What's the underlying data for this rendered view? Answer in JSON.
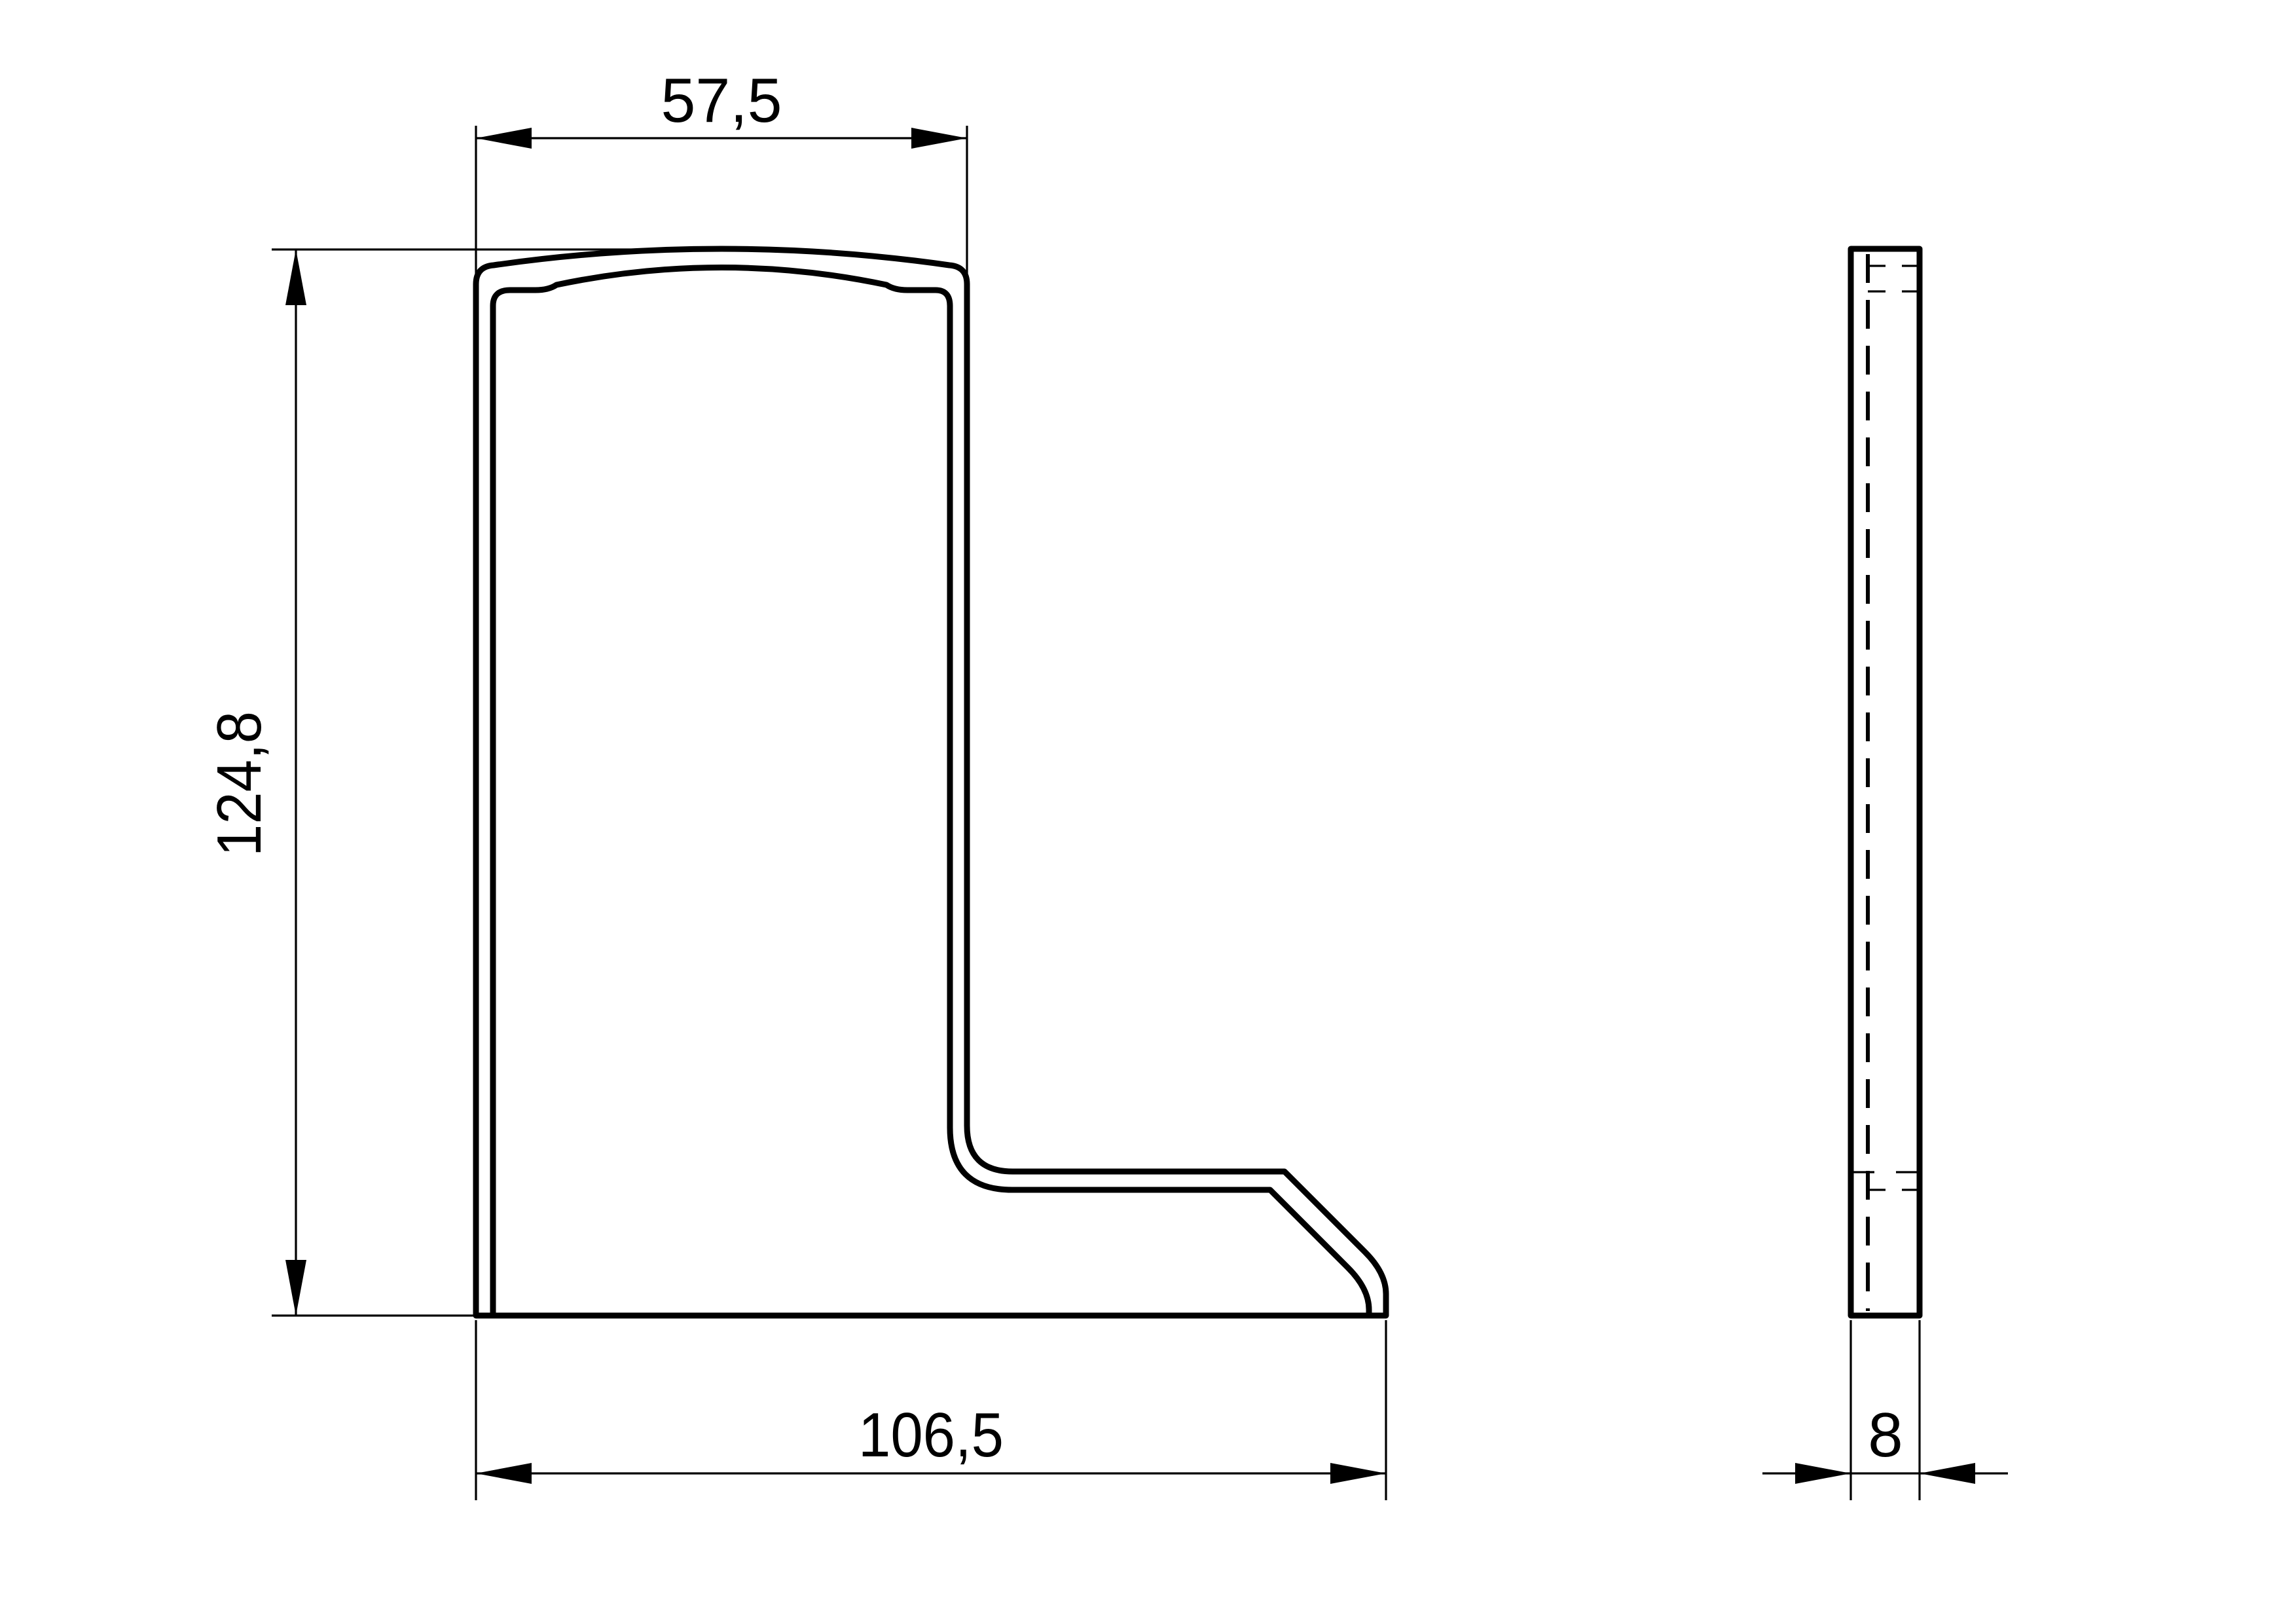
{
  "drawing": {
    "type": "technical-2d-drawing",
    "background_color": "#ffffff",
    "line_color": "#000000",
    "views": [
      {
        "id": "front",
        "description": "L-shaped profile cross-section front view"
      },
      {
        "id": "side",
        "description": "narrow side view with hidden edge line"
      }
    ],
    "dimensions": {
      "top_width": {
        "label": "57,5",
        "value": 57.5
      },
      "height": {
        "label": "124,8",
        "value": 124.8
      },
      "bottom_width": {
        "label": "106,5",
        "value": 106.5
      },
      "thickness": {
        "label": "8",
        "value": 8
      }
    }
  }
}
